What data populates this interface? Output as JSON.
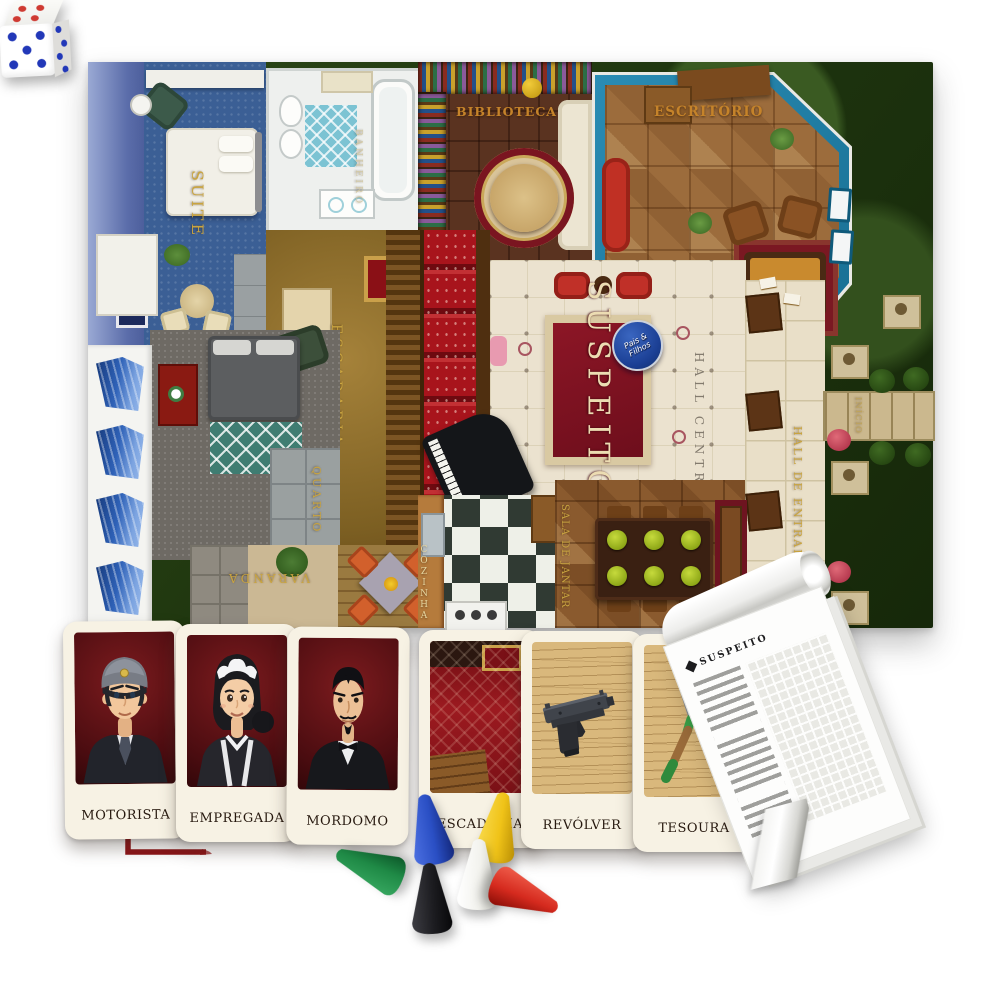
{
  "board": {
    "badge_label": "Pais & Filhos",
    "center_carpet_label": "SUSPEITO",
    "start_label": "INÍCIO",
    "rooms": {
      "suite": "SUITE",
      "banheiro": "BANHEIRO",
      "biblioteca": "BIBLIOTECA",
      "escritorio": "ESCRITÓRIO",
      "escadaria": "ESCADARIA",
      "quarto": "QUARTO",
      "varanda": "VARANDA",
      "cozinha": "COZINHA",
      "sala_de_jantar": "SALA DE JANTAR",
      "hall_central": "HALL CENTRAL",
      "hall_de_entrada": "HALL DE ENTRADA"
    }
  },
  "cards": [
    {
      "label": "MOTORISTA",
      "kind": "suspect-driver"
    },
    {
      "label": "EMPREGADA",
      "kind": "suspect-maid"
    },
    {
      "label": "MORDOMO",
      "kind": "suspect-butler"
    },
    {
      "label": "ESCADARIA",
      "kind": "room-staircase"
    },
    {
      "label": "REVÓLVER",
      "kind": "weapon-pistol"
    },
    {
      "label": "TESOURA",
      "kind": "weapon-garden-shears"
    }
  ],
  "notepad": {
    "header": "SUSPEITO",
    "list_rows": 21,
    "grid_columns": 10
  },
  "die": {
    "top_face_pips": 4,
    "front_face_pips": 5,
    "side_face_pips": 6,
    "top_pip_color": "#cf3a32",
    "front_pip_color": "#2238b8",
    "body_color": "#f7f7f4"
  },
  "pawns": [
    {
      "color_name": "green",
      "hex": "#1f8a46"
    },
    {
      "color_name": "blue",
      "hex": "#2a4fc4"
    },
    {
      "color_name": "yellow",
      "hex": "#f0c318"
    },
    {
      "color_name": "white",
      "hex": "#f2f2ed"
    },
    {
      "color_name": "black",
      "hex": "#1c1c20"
    },
    {
      "color_name": "red",
      "hex": "#d52a1e"
    }
  ],
  "colors": {
    "lawn_green": "#24390f",
    "window_teal": "#1f7fa6",
    "carpet_red": "#7c1120",
    "label_gold": "#c9a440",
    "card_cream": "#f7f2e4",
    "mark_red": "#8e1216"
  }
}
